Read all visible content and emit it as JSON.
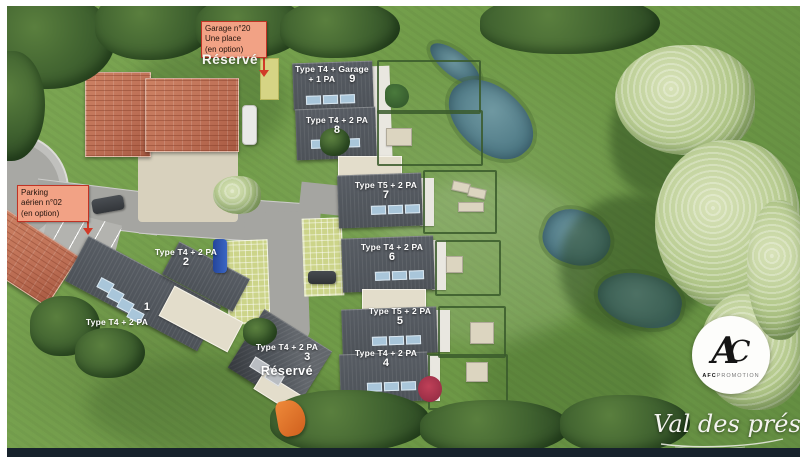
{
  "annotations": {
    "garage_note": {
      "lines": [
        "Garage n°20",
        "Une place",
        "(en option)"
      ]
    },
    "parking_note": {
      "lines": [
        "Parking",
        "aérien n°02",
        "(en option)"
      ]
    },
    "reserved_top": "Réservé"
  },
  "units": [
    {
      "number": "1",
      "line1": "Type T4 + 2 PA"
    },
    {
      "number": "2",
      "line1": "Type T4 + 2 PA"
    },
    {
      "number": "3",
      "line1": "Type T4 + 2 PA",
      "reserved": "Réservé"
    },
    {
      "number": "4",
      "line1": "Type T4 + 2 PA"
    },
    {
      "number": "5",
      "line1": "Type T5 + 2 PA"
    },
    {
      "number": "6",
      "line1": "Type T4 + 2 PA"
    },
    {
      "number": "7",
      "line1": "Type T5 + 2 PA"
    },
    {
      "number": "8",
      "line1": "Type T4 + 2 PA"
    },
    {
      "number": "9",
      "line1": "Type T4 + Garage",
      "line2": "+ 1 PA"
    }
  ],
  "branding": {
    "monogram_a": "A",
    "monogram_c": "C",
    "company_bold": "AFC",
    "company_light": "PROMOTION",
    "project_name": "Val des prés"
  },
  "colors": {
    "note_bg": "#f2a285",
    "note_border": "#c03325",
    "arrow": "#d13a28",
    "roof_dark": "#4d5258",
    "roof_red": "#bd6f55",
    "panel_blue": "#a9c6da",
    "pond": "#57808d",
    "road": "#a5a5a1",
    "paver": "#ccd489",
    "terrace": "#e3ddcb",
    "hedge": "#3a5a2b",
    "bottom_bar": "#17222c",
    "label_text": "#ffffff"
  }
}
